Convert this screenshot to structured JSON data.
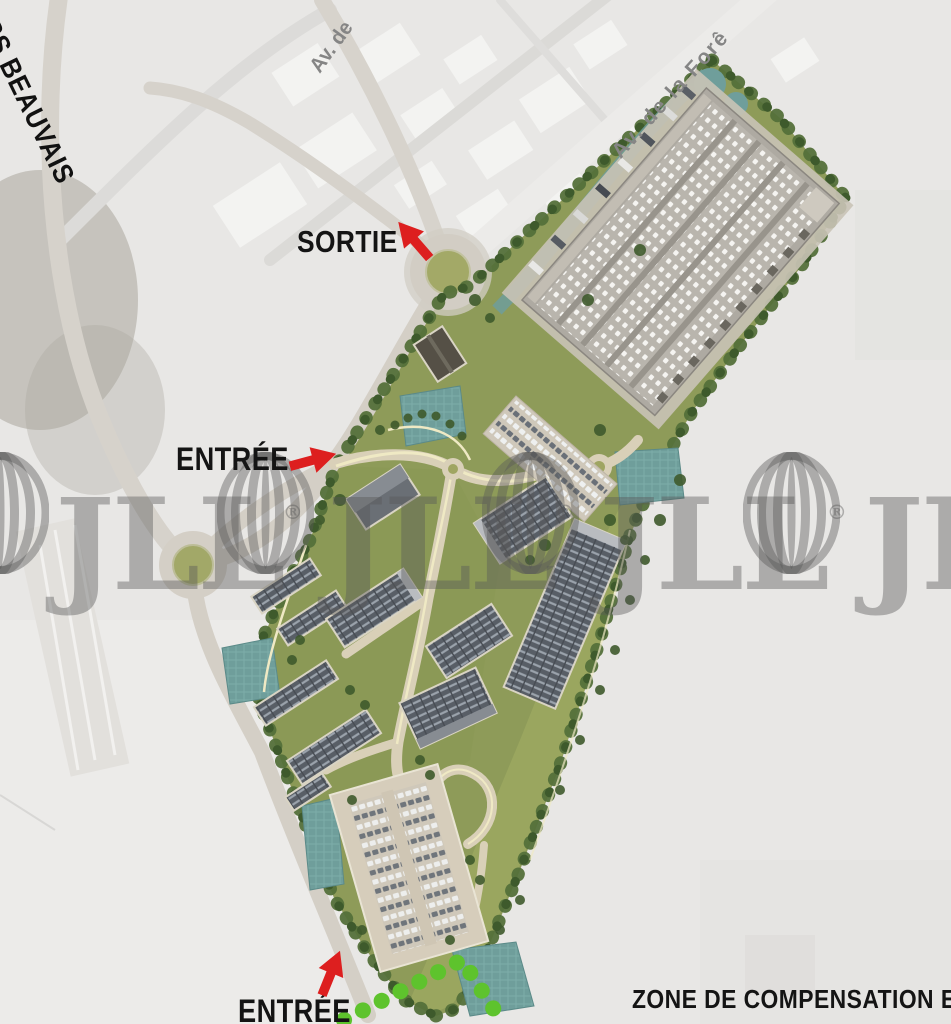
{
  "map": {
    "streets": {
      "beauvais": "RS BEAUVAIS",
      "avenue_north": "Av. de",
      "avenue_foret": "Av. de la Forê"
    },
    "annotations": {
      "sortie": "SORTIE",
      "entree_mid": "ENTRÉE",
      "entree_bottom": "ENTRÉE",
      "zone_compensation": "ZONE DE COMPENSATION E"
    },
    "watermark": {
      "brand": "JLL",
      "registered": "®"
    },
    "legend_colors": {
      "arrow_red": "#DD1F1F",
      "site_green": "#8E9B59",
      "lawn_light_green": "#9AA65F",
      "tree_dark_green": "#4C673A",
      "water_teal": "#6F9E9B",
      "road_tan": "#D4CFC6",
      "path_cream": "#EFE9C4",
      "context_gray": "#E8E7E5",
      "label_black": "#141414",
      "watermark_gray": "#585858",
      "compensation_dot_green": "#5EC32D",
      "roundabout_green": "#A3A967"
    }
  }
}
